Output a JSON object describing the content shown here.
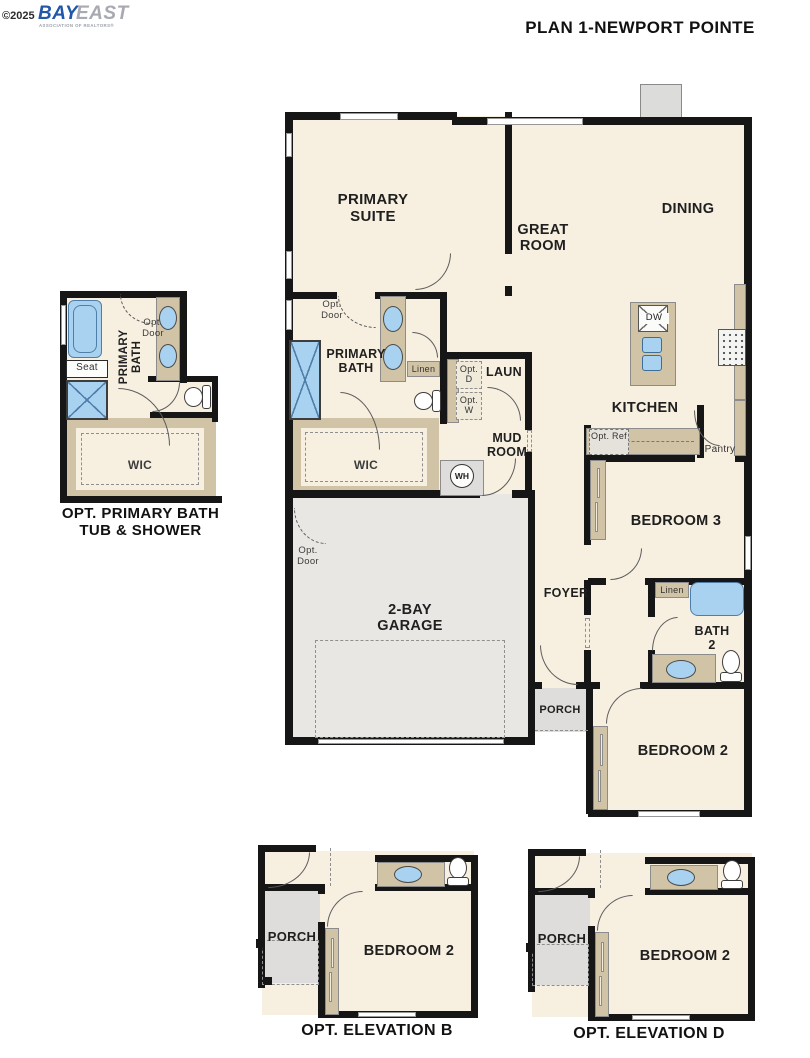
{
  "page": {
    "copyright": "©2025",
    "brand_primary": "BAY",
    "brand_secondary": "EAST",
    "brand_tagline": "ASSOCIATION OF REALTORS®",
    "title": "PLAN 1-NEWPORT POINTE"
  },
  "colors": {
    "floor": "#f7f0e1",
    "counter": "#d1c3a5",
    "fixture_fill": "#a9d2f1",
    "fixture_border": "#4f7fa9",
    "garage": "#e8e7e3",
    "porch": "#dedddb",
    "wall": "#161616",
    "dashed_lines": "#8f8f8f",
    "label": "#1f1f1f",
    "brand_blue": "#2156a8",
    "brand_gray": "#a7aab1"
  },
  "opt_primary_bath_detail": {
    "labels": {
      "seat": "Seat",
      "primary_bath": "PRIMARY BATH",
      "opt_door": "Opt. Door",
      "wic": "WIC"
    },
    "caption_line1": "OPT. PRIMARY BATH",
    "caption_line2": "TUB & SHOWER"
  },
  "main_plan": {
    "rooms": {
      "primary_suite": "PRIMARY SUITE",
      "great_room": "GREAT ROOM",
      "dining": "DINING",
      "kitchen": "KITCHEN",
      "primary_bath": "PRIMARY BATH",
      "laundry": "LAUN",
      "mud_room": "MUD ROOM",
      "wic": "WIC",
      "foyer": "FOYER",
      "bedroom3": "BEDROOM 3",
      "bath2": "BATH 2",
      "bedroom2": "BEDROOM 2",
      "garage": "2-BAY GARAGE",
      "porch": "PORCH",
      "pantry": "Pantry"
    },
    "features": {
      "linen": "Linen",
      "opt_door": "Opt. Door",
      "opt_dryer": "Opt. D",
      "opt_washer": "Opt. W",
      "opt_ref": "Opt. Ref",
      "water_heater": "WH",
      "dishwasher": "DW"
    }
  },
  "opt_elevation_b": {
    "porch": "PORCH",
    "bedroom2": "BEDROOM 2",
    "caption": "OPT. ELEVATION B"
  },
  "opt_elevation_d": {
    "porch": "PORCH",
    "bedroom2": "BEDROOM 2",
    "caption": "OPT. ELEVATION D"
  }
}
